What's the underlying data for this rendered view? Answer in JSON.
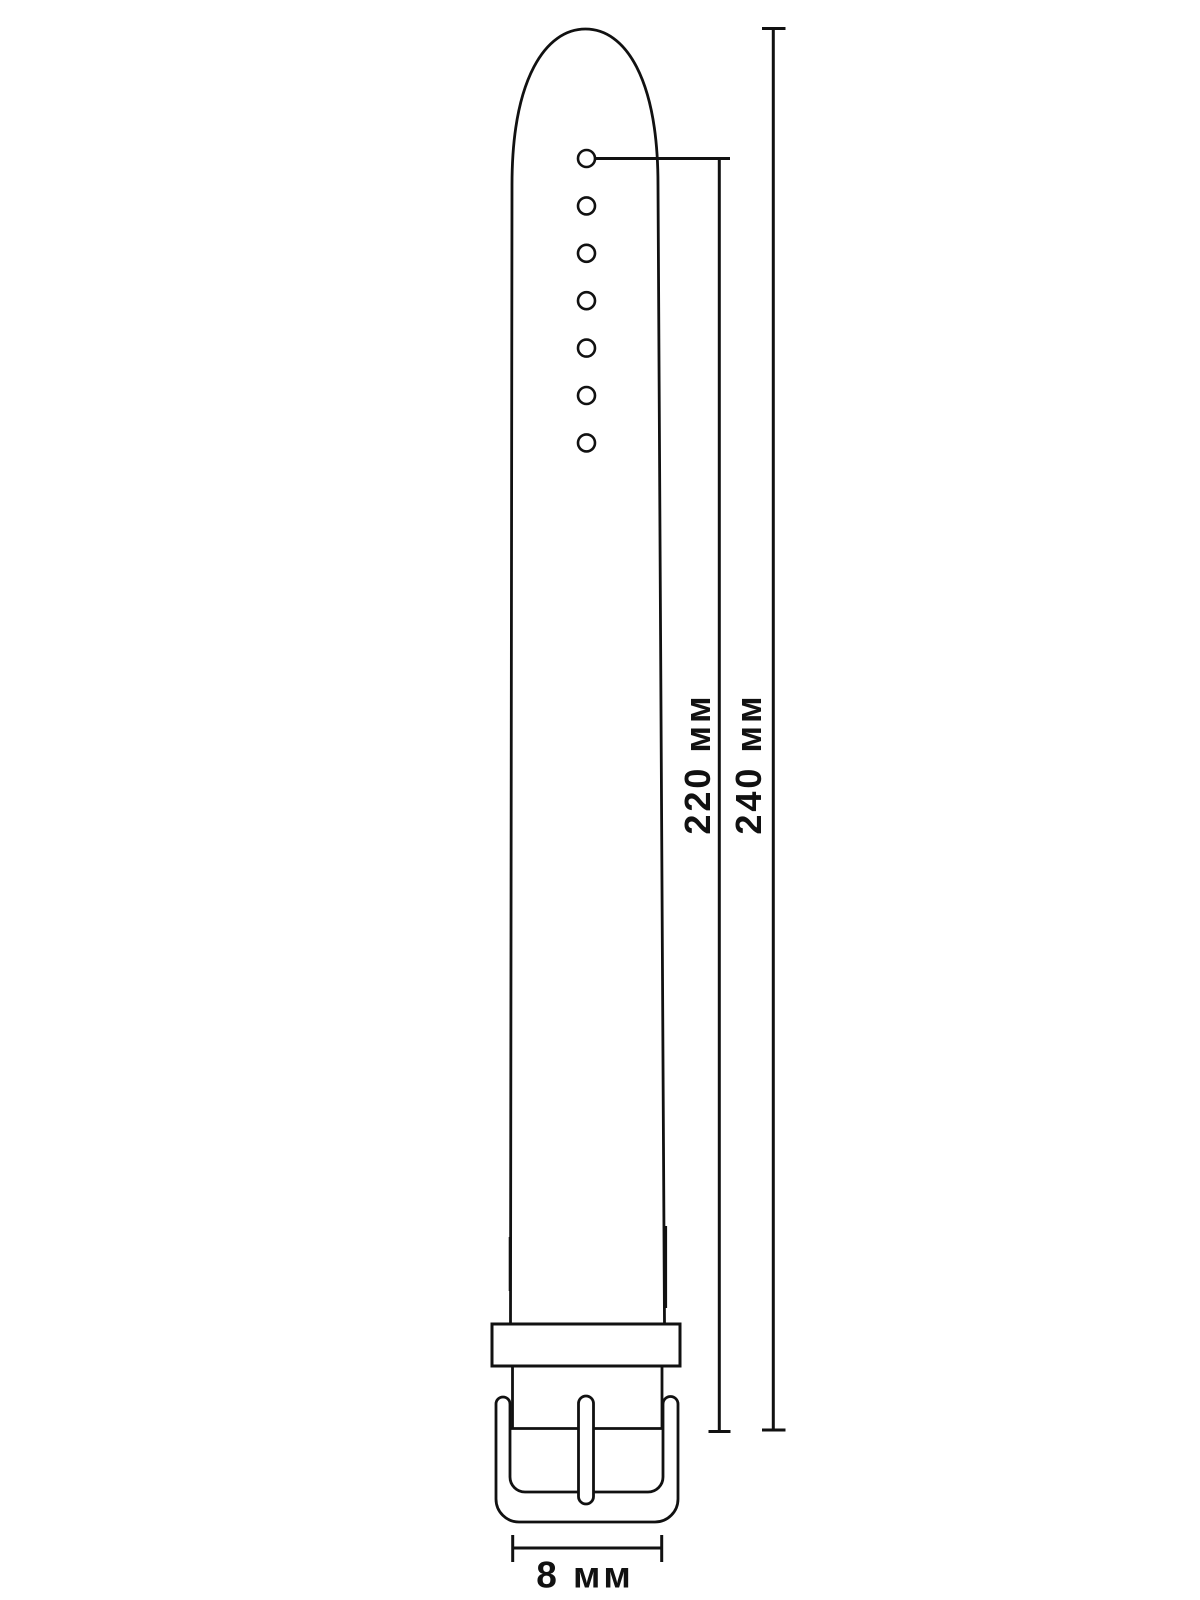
{
  "diagram": {
    "subject": "watch strap with buckle, dimension drawing",
    "colors": {
      "line": "#111111",
      "background": "#ffffff"
    },
    "strap": {
      "hole_count": 7
    },
    "dimensions": [
      {
        "id": "first-hole-to-buckle",
        "label": "220 мм",
        "orientation": "vertical"
      },
      {
        "id": "tip-to-buckle",
        "label": "240 мм",
        "orientation": "vertical"
      },
      {
        "id": "strap-width",
        "label": "8 мм",
        "orientation": "horizontal"
      }
    ]
  }
}
